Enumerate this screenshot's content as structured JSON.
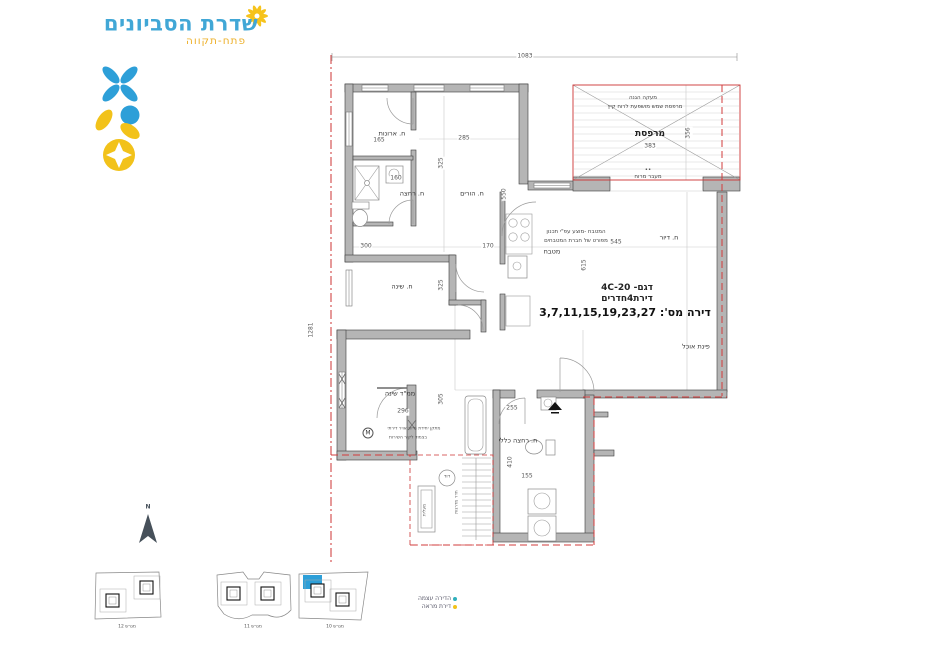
{
  "brand": {
    "title": "שדרת הסביונים",
    "subtitle": "פתח-תקווה"
  },
  "plan": {
    "overall": {
      "width": "1083",
      "height": "1281"
    },
    "apartment": {
      "model": "דגם- 4C-20",
      "type": "דירת4חדרים",
      "numbers": "דירה מס': 3,7,11,15,19,23,27"
    },
    "rooms": {
      "closet": {
        "name": "ח. ארונות",
        "dim": "165"
      },
      "parents_bath": {
        "name": "ח. רחצה",
        "dim": "160"
      },
      "parents": {
        "name": "ח. הורים",
        "w": "285",
        "h1": "325",
        "h2": "550"
      },
      "bedroom": {
        "name": "ח. שינה",
        "w": "300",
        "w2": "170",
        "h": "325"
      },
      "mamad": {
        "name": "ממ\"ד שינה",
        "w": "296",
        "h": "305"
      },
      "living": {
        "name": "ח. דיור",
        "w": "545",
        "h": "615"
      },
      "dining": {
        "name": "פינת אוכל"
      },
      "kitchen": {
        "name": "מטבח",
        "note1": "המטבח -מוצע עפ\"י תכנון",
        "note2": "מפורט של חברת המטבחים"
      },
      "bath": {
        "name": "ח. רחצה כללי",
        "d1": "255",
        "d2": "410",
        "d3": "155"
      },
      "balcony": {
        "name": "מרפסת",
        "area": "383",
        "h": "356",
        "railing": "מעקה הגנה",
        "note": "מרפסת שמש מושפעת לרוח קיץ",
        "dots": "••",
        "passage": "מעבר מרוח"
      },
      "boiler": "דוד",
      "stairwell": "חדר מדרגות",
      "elevator": "מעלית"
    },
    "ac_note": {
      "symbol": "M",
      "line1": "מתקן יחידת מיזוג אויר דירתי",
      "line2": "בצמוד לקיר השירות"
    }
  },
  "legend": {
    "items": [
      {
        "label": "הדירה עצמה",
        "color": "#2fb0bc"
      },
      {
        "label": "דירת מראה",
        "color": "#f2c21a"
      }
    ]
  },
  "site_plans": {
    "lots": [
      {
        "label": "מגרש 12"
      },
      {
        "label": "מגרש 11"
      },
      {
        "label": "מגרש 10"
      }
    ],
    "highlight_color": "#2d9fd8"
  },
  "compass": {
    "label": "N"
  },
  "colors": {
    "brand_blue": "#41a7d6",
    "brand_yellow": "#f2c21a",
    "wall_gray": "#b5b5b5",
    "boundary_red": "#cc3333"
  }
}
